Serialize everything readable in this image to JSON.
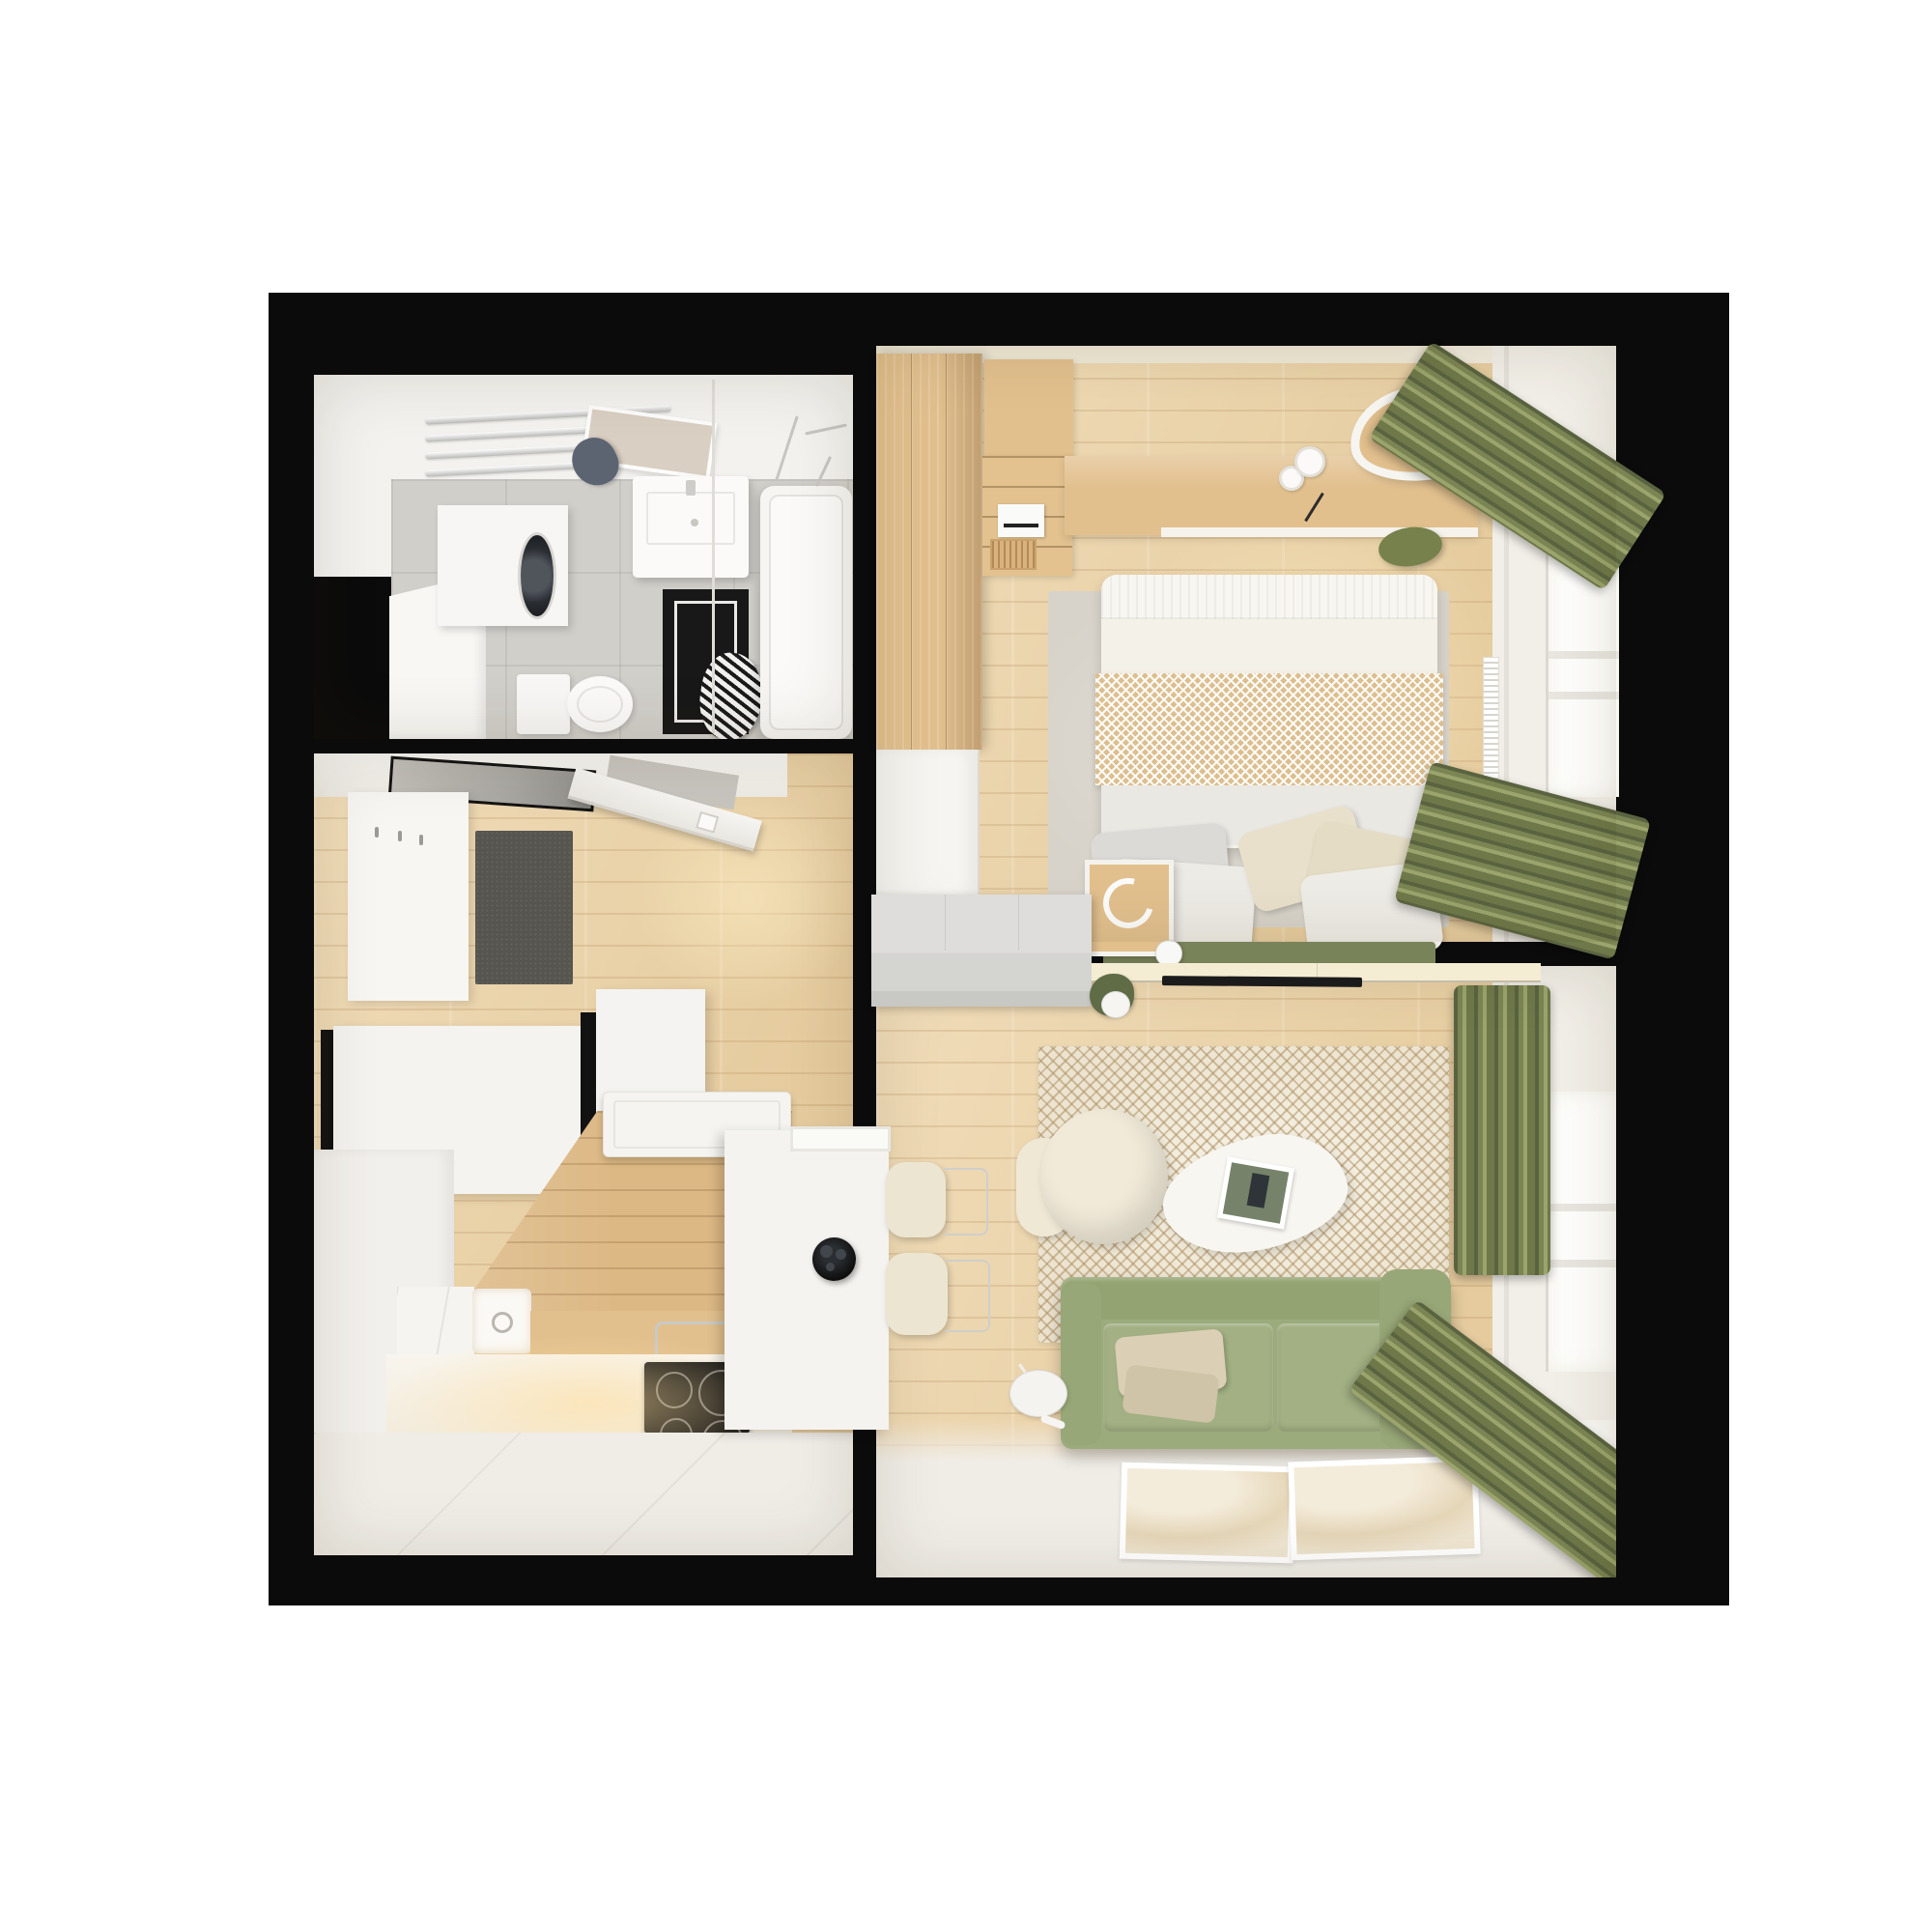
{
  "scene": {
    "type": "3d_floor_plan_render",
    "view": "top_down",
    "description": "Top-down 3D render of a small one-bedroom apartment: bathroom and entry hall with kitchen on the left, bedroom (top right) and living room (bottom right), black walls, white background",
    "background": "#ffffff"
  },
  "palette": {
    "wall_black": "#0b0b0b",
    "floor_wood": "#ecd3a6",
    "wood_mid": "#e2c08e",
    "wood_kitchen": "#dcb884",
    "floor_white": "#f0ede7",
    "tile_gray": "#d1cfca",
    "rug_gray": "#d7d3ca",
    "rug_cream": "#efe8d6",
    "rug_tan": "#ab8c5e",
    "rug_black": "#181818",
    "towel_navy": "#5c6472",
    "sofa_green": "#9cab7c",
    "bench_green": "#79835a",
    "pouf_green": "#76814b",
    "curtain_green": "#7b8553",
    "blanket_tan": "#dcbf8f",
    "pillow_cream": "#e8e0ca",
    "pillow_white": "#edebe5",
    "pillow_gray": "#dbdad6",
    "sideboard_cream": "#f4edd3",
    "dresser_gray": "#d4d4d1",
    "mat_gray": "#57554f",
    "cooktop_black": "#161616",
    "plant_green": "#5f6c45"
  },
  "rooms": {
    "bathroom": {
      "objects": [
        "towel-radiator",
        "tilted-mirror",
        "navy-towel",
        "sink-vanity",
        "washing-machine-cabinet",
        "toilet",
        "black-bath-mat",
        "striped-towel",
        "bathtub",
        "shower-rod",
        "tall-white-cabinet"
      ]
    },
    "entry_hall": {
      "objects": [
        "black-framed-mirror",
        "open-entry-door",
        "coat-panel",
        "dark-doormat",
        "white-wardrobe-large",
        "white-wardrobe-small"
      ]
    },
    "kitchen": {
      "objects": [
        "wood-plank-wall",
        "extractor-hood",
        "white-cabinets",
        "drawer-unit",
        "sink",
        "wood-counter",
        "induction-cooktop",
        "white-tile-floor",
        "island-column",
        "fruit-bowl",
        "bar-stool-1",
        "bar-stool-2"
      ]
    },
    "bedroom": {
      "objects": [
        "wood-wardrobe",
        "corner-cabinet",
        "shelf-unit",
        "printer",
        "wicker-basket",
        "wood-desk",
        "organic-mirror",
        "green-pouf",
        "gray-rug",
        "bed",
        "herringbone-blanket",
        "pillows",
        "green-bench",
        "nightstand",
        "headphones",
        "sphere-lamp",
        "radiator",
        "window",
        "green-curtains",
        "gray-dresser",
        "white-door"
      ]
    },
    "living_room": {
      "objects": [
        "herringbone-rug",
        "cream-armchair",
        "cream-bolster",
        "organic-coffee-table",
        "magazine",
        "green-sofa",
        "sofa-pillows",
        "floor-poster-1",
        "floor-poster-2",
        "floor-lamp",
        "radiator",
        "window",
        "green-curtains",
        "tv-sideboard",
        "tv",
        "potted-plant"
      ]
    }
  }
}
